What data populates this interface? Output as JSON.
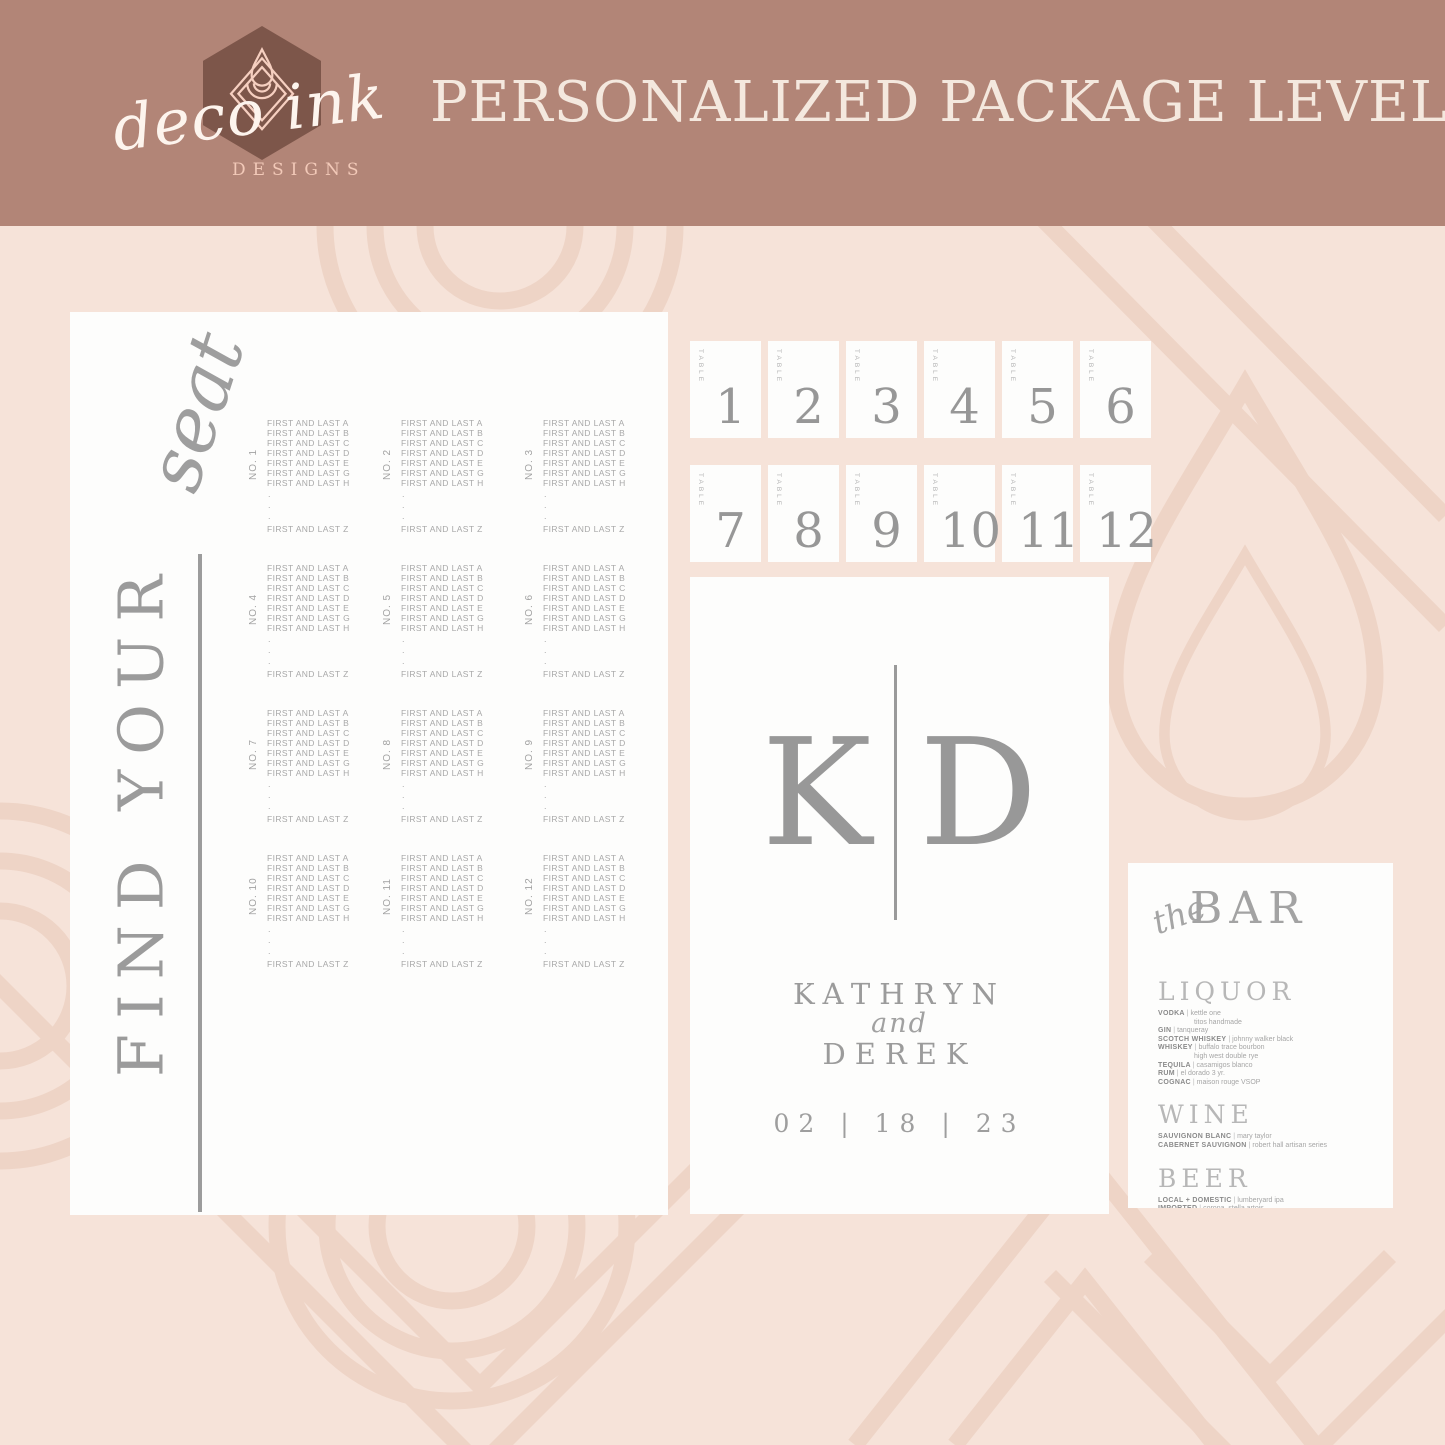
{
  "header": {
    "logo": {
      "script": "deco ink",
      "designs": "DESIGNS"
    },
    "title": "PERSONALIZED PACKAGE LEVEL II"
  },
  "seating_chart": {
    "script_word": "seat",
    "heading": "FIND YOUR",
    "guests": [
      "FIRST AND LAST A",
      "FIRST AND LAST B",
      "FIRST AND LAST C",
      "FIRST AND LAST D",
      "FIRST AND LAST E",
      "FIRST AND LAST G",
      "FIRST AND LAST H"
    ],
    "ellipsis": [
      ".",
      ".",
      "."
    ],
    "last_guest": "FIRST AND LAST Z",
    "tables": [
      "NO. 1",
      "NO. 2",
      "NO. 3",
      "NO. 4",
      "NO. 5",
      "NO. 6",
      "NO. 7",
      "NO. 8",
      "NO. 9",
      "NO. 10",
      "NO. 11",
      "NO. 12"
    ]
  },
  "table_cards": {
    "label": "TABLE",
    "numbers": [
      "1",
      "2",
      "3",
      "4",
      "5",
      "6",
      "7",
      "8",
      "9",
      "10",
      "11",
      "12"
    ]
  },
  "welcome_sign": {
    "monogram_left": "K",
    "monogram_right": "D",
    "name_top": "KATHRYN",
    "conjunction": "and",
    "name_bottom": "DEREK",
    "date": "02  |  18  |  23"
  },
  "bar_menu": {
    "script_word": "the",
    "title": "BAR",
    "sections": [
      {
        "title": "LIQUOR",
        "items": [
          {
            "label": "VODKA",
            "values": [
              "kettle one",
              "titos handmade"
            ]
          },
          {
            "label": "GIN",
            "values": [
              "tanqueray"
            ]
          },
          {
            "label": "SCOTCH WHISKEY",
            "values": [
              "johnny walker black"
            ]
          },
          {
            "label": "WHISKEY",
            "values": [
              "buffalo trace bourbon",
              "high west double rye"
            ]
          },
          {
            "label": "TEQUILA",
            "values": [
              "casamigos blanco"
            ]
          },
          {
            "label": "RUM",
            "values": [
              "el dorado 3 yr."
            ]
          },
          {
            "label": "COGNAC",
            "values": [
              "maison rouge VSOP"
            ]
          }
        ]
      },
      {
        "title": "WINE",
        "items": [
          {
            "label": "SAUVIGNON BLANC",
            "values": [
              "mary taylor"
            ]
          },
          {
            "label": "CABERNET SAUVIGNON",
            "values": [
              "robert hall artisan series"
            ]
          }
        ]
      },
      {
        "title": "BEER",
        "items": [
          {
            "label": "LOCAL + DOMESTIC",
            "values": [
              "lumberyard ipa"
            ]
          },
          {
            "label": "IMPORTED",
            "values": [
              "corona, stella artois"
            ]
          },
          {
            "label": "NON ALCOHOLIC",
            "values": [
              "clausthaler classic"
            ]
          }
        ]
      }
    ]
  },
  "colors": {
    "header_bg": "#b28577",
    "page_bg": "#f6e3d9",
    "pattern_line": "#eed4c6",
    "card_bg": "#fdfdfc",
    "ink_gray": "#9b9b9b",
    "logo_hex": "#7d564a",
    "logo_stroke": "#f6cfc0",
    "cream_text": "#f4e8de"
  }
}
